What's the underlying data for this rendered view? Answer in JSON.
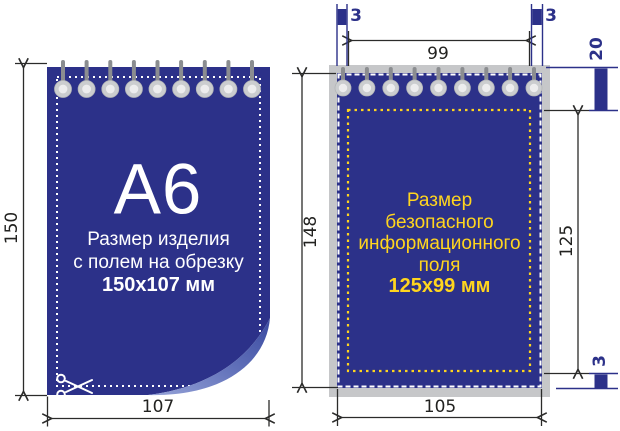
{
  "colors": {
    "page_blue": "#2c3189",
    "bleed_gray": "#c6c7c9",
    "safe_yellow": "#ffd51e",
    "dimension_line": "#2b2b2a"
  },
  "left_pad": {
    "format_label": "A6",
    "caption_line1": "Размер изделия",
    "caption_line2": "с полем на обрезку",
    "caption_line3": "150x107 мм",
    "dim_height_mm": "150",
    "dim_width_mm": "107"
  },
  "right_pad": {
    "caption_line1": "Размер",
    "caption_line2": "безопасного",
    "caption_line3": "информационного",
    "caption_line4": "поля",
    "caption_line5": "125x99 мм",
    "dim_trim_height_mm": "148",
    "dim_trim_width_mm": "105",
    "dim_safe_height_mm": "125",
    "dim_safe_width_mm": "99",
    "dim_margin_left_mm": "3",
    "dim_margin_right_mm": "3",
    "dim_margin_bottom_mm": "3",
    "dim_binding_zone_mm": "20"
  }
}
